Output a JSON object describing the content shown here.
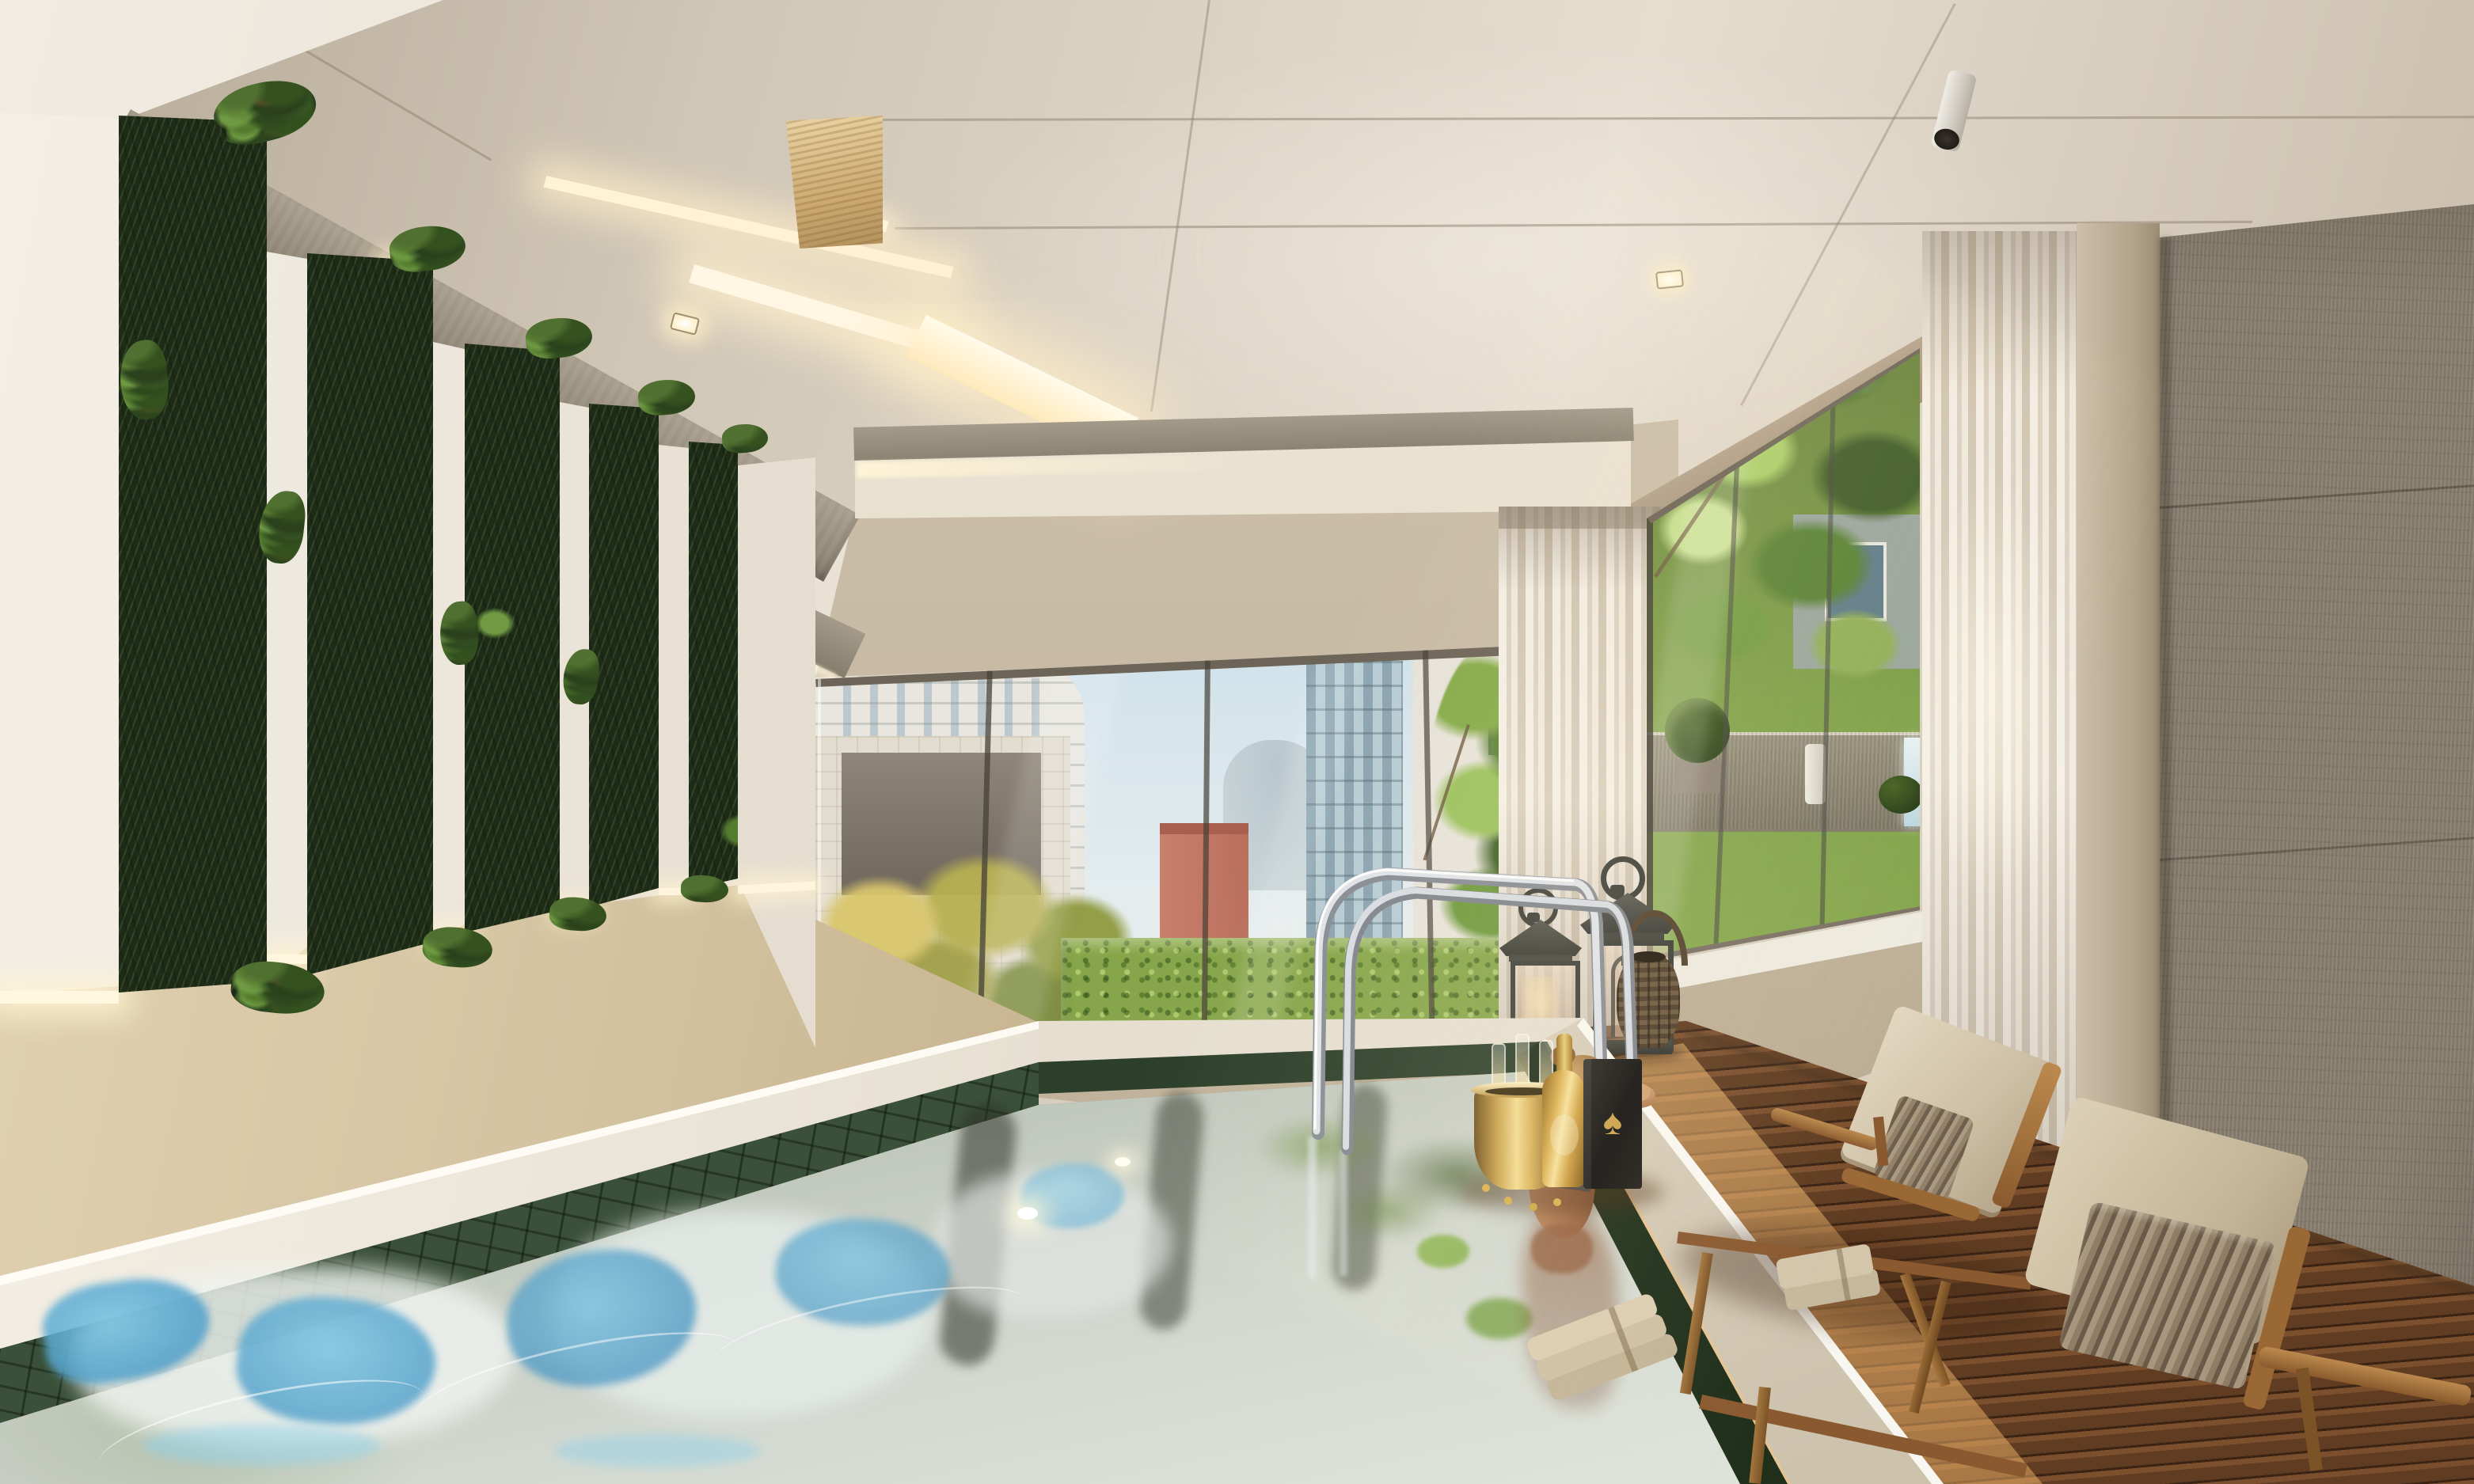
{
  "meta": {
    "title": "Indoor pool lounge with vertical gardens — architectural rendering",
    "description": "Sunlit indoor swimming pool with green mosaic tile, white marble coping, vertical garden wall panels, travertine and concrete surfaces, floor-to-ceiling windows to a city garden terrace, hardwood deck with chaise lounges, lanterns and a champagne set."
  },
  "icons": {
    "spade": "♠"
  },
  "scene": {
    "room": "indoor swimming pool lounge",
    "time_of_day": "daytime, strong sunlight from the right windows",
    "lighting": [
      "recessed linear ceiling light coves",
      "square recessed ceiling spotlights",
      "cylinder ceiling spotlight",
      "wall-wash uplights over travertine",
      "natural sunlight"
    ],
    "materials": [
      "beige lacquered ceiling panels",
      "raw concrete beams and feature wall",
      "white wall panels",
      "vertical garden plant strips",
      "travertine stone base",
      "white marble pool coping",
      "green stone mosaic pool tile",
      "ipe hardwood deck",
      "sheer white curtains"
    ]
  },
  "objects": {
    "ceiling": {
      "label": "panelled ceiling with light coves"
    },
    "left_wall": {
      "label": "white panel wall with vertical gardens"
    },
    "plants": {
      "label": "vertical garden strips",
      "count": 5
    },
    "stone_base": {
      "label": "travertine stone wainscot with uplights"
    },
    "back_window": {
      "label": "back window: city towers, green hedge, trees"
    },
    "right_window": {
      "label": "right window: garden trees, stone wall, waterfall, topiary, candle"
    },
    "curtains": {
      "label": "sheer white curtain panels",
      "count": 2
    },
    "concrete_wall": {
      "label": "raw concrete feature wall"
    },
    "pool": {
      "label": "green mosaic swimming pool with sky reflections"
    },
    "coping": {
      "label": "white marble pool coping"
    },
    "handrail": {
      "label": "chrome pool ladder handrail"
    },
    "woman": {
      "label": "woman resting at the pool edge"
    },
    "deck": {
      "label": "hardwood pool deck in sunlight"
    },
    "lanterns": {
      "label": "decorative floor lanterns",
      "count": 3,
      "types": [
        "grey metal lantern",
        "tall grey metal lantern",
        "rattan barrel lantern"
      ]
    },
    "champagne": {
      "label": "champagne set",
      "items": [
        "gold ice bucket with glasses and charms",
        "gold champagne bottle",
        "black gift box with gold spade emblem"
      ]
    },
    "towels": {
      "label": "folded beige towels",
      "locations": [
        "pool coping",
        "chaise seat"
      ]
    },
    "loungers": {
      "label": "wooden chaise lounges with beige cushions",
      "count": 2,
      "pillows": "brown striped lumbar pillows"
    }
  },
  "palette": {
    "ceiling": "#d8cec0",
    "concrete": "#8b8172",
    "wall_white": "#ece6da",
    "plant_green_dark": "#2a411c",
    "plant_green_light": "#6f9a43",
    "travertine": "#cdbb98",
    "marble": "#efe9dc",
    "pool_tile": "#3a5038",
    "water_dark": "#555a4a",
    "water_light": "#d6dad2",
    "reflection_blue": "#5aa7cf",
    "wood_deck": "#8a5a33",
    "deck_sunlit": "#e0a868",
    "lounger_cushion": "#d6c9ae",
    "gold": "#d9b14e",
    "lantern_metal": "#3f403a",
    "curtain": "#efe9e0",
    "hedge": "#87a64b",
    "sky": "#cfe1ea",
    "salmon_building": "#c9806b"
  }
}
